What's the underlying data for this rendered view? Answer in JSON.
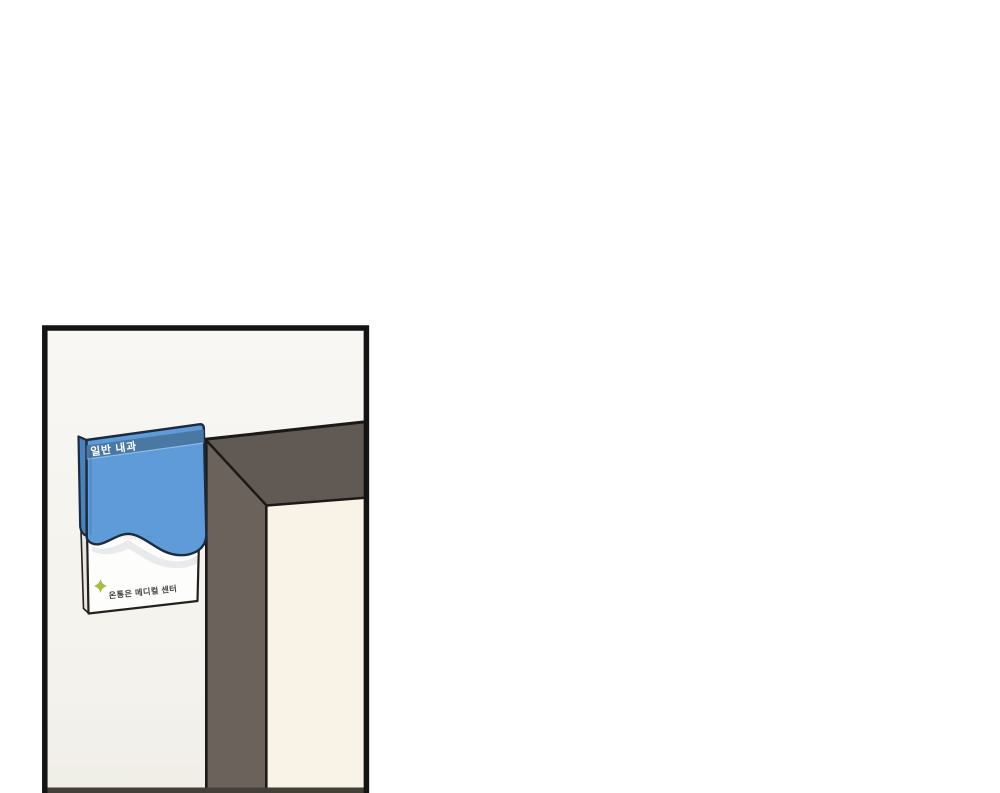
{
  "page": {
    "kind_label": "webtoon panel",
    "background_note": "blank white page, single partial panel at lower left"
  },
  "panel": {
    "sign": {
      "department_label": "일반 내과",
      "clinic_name": "온통은 메디컬 센터",
      "cross_icon": "medical-cross-icon"
    },
    "door_frame_note": "dark door frame corner seen at an angle, vertical column runs off bottom edge"
  },
  "colors": {
    "page_background": "#ffffff",
    "panel_border": "#141414",
    "wall_left": "#f5f3ee",
    "wall_doorway": "#f9f2e6",
    "door_frame_beam": "#615a54",
    "door_frame_column": "#6a625b",
    "sign_blue": "#5e9bd8",
    "sign_header_blue": "#4a78a4",
    "sign_side_blue": "#4b82b8",
    "paper_white": "#fdfdfc",
    "paper_side": "#e9e6e1",
    "cross_green": "#a2c045",
    "clinic_text": "#45443e",
    "outline": "#23211e",
    "floor_strip": "#453f39"
  }
}
